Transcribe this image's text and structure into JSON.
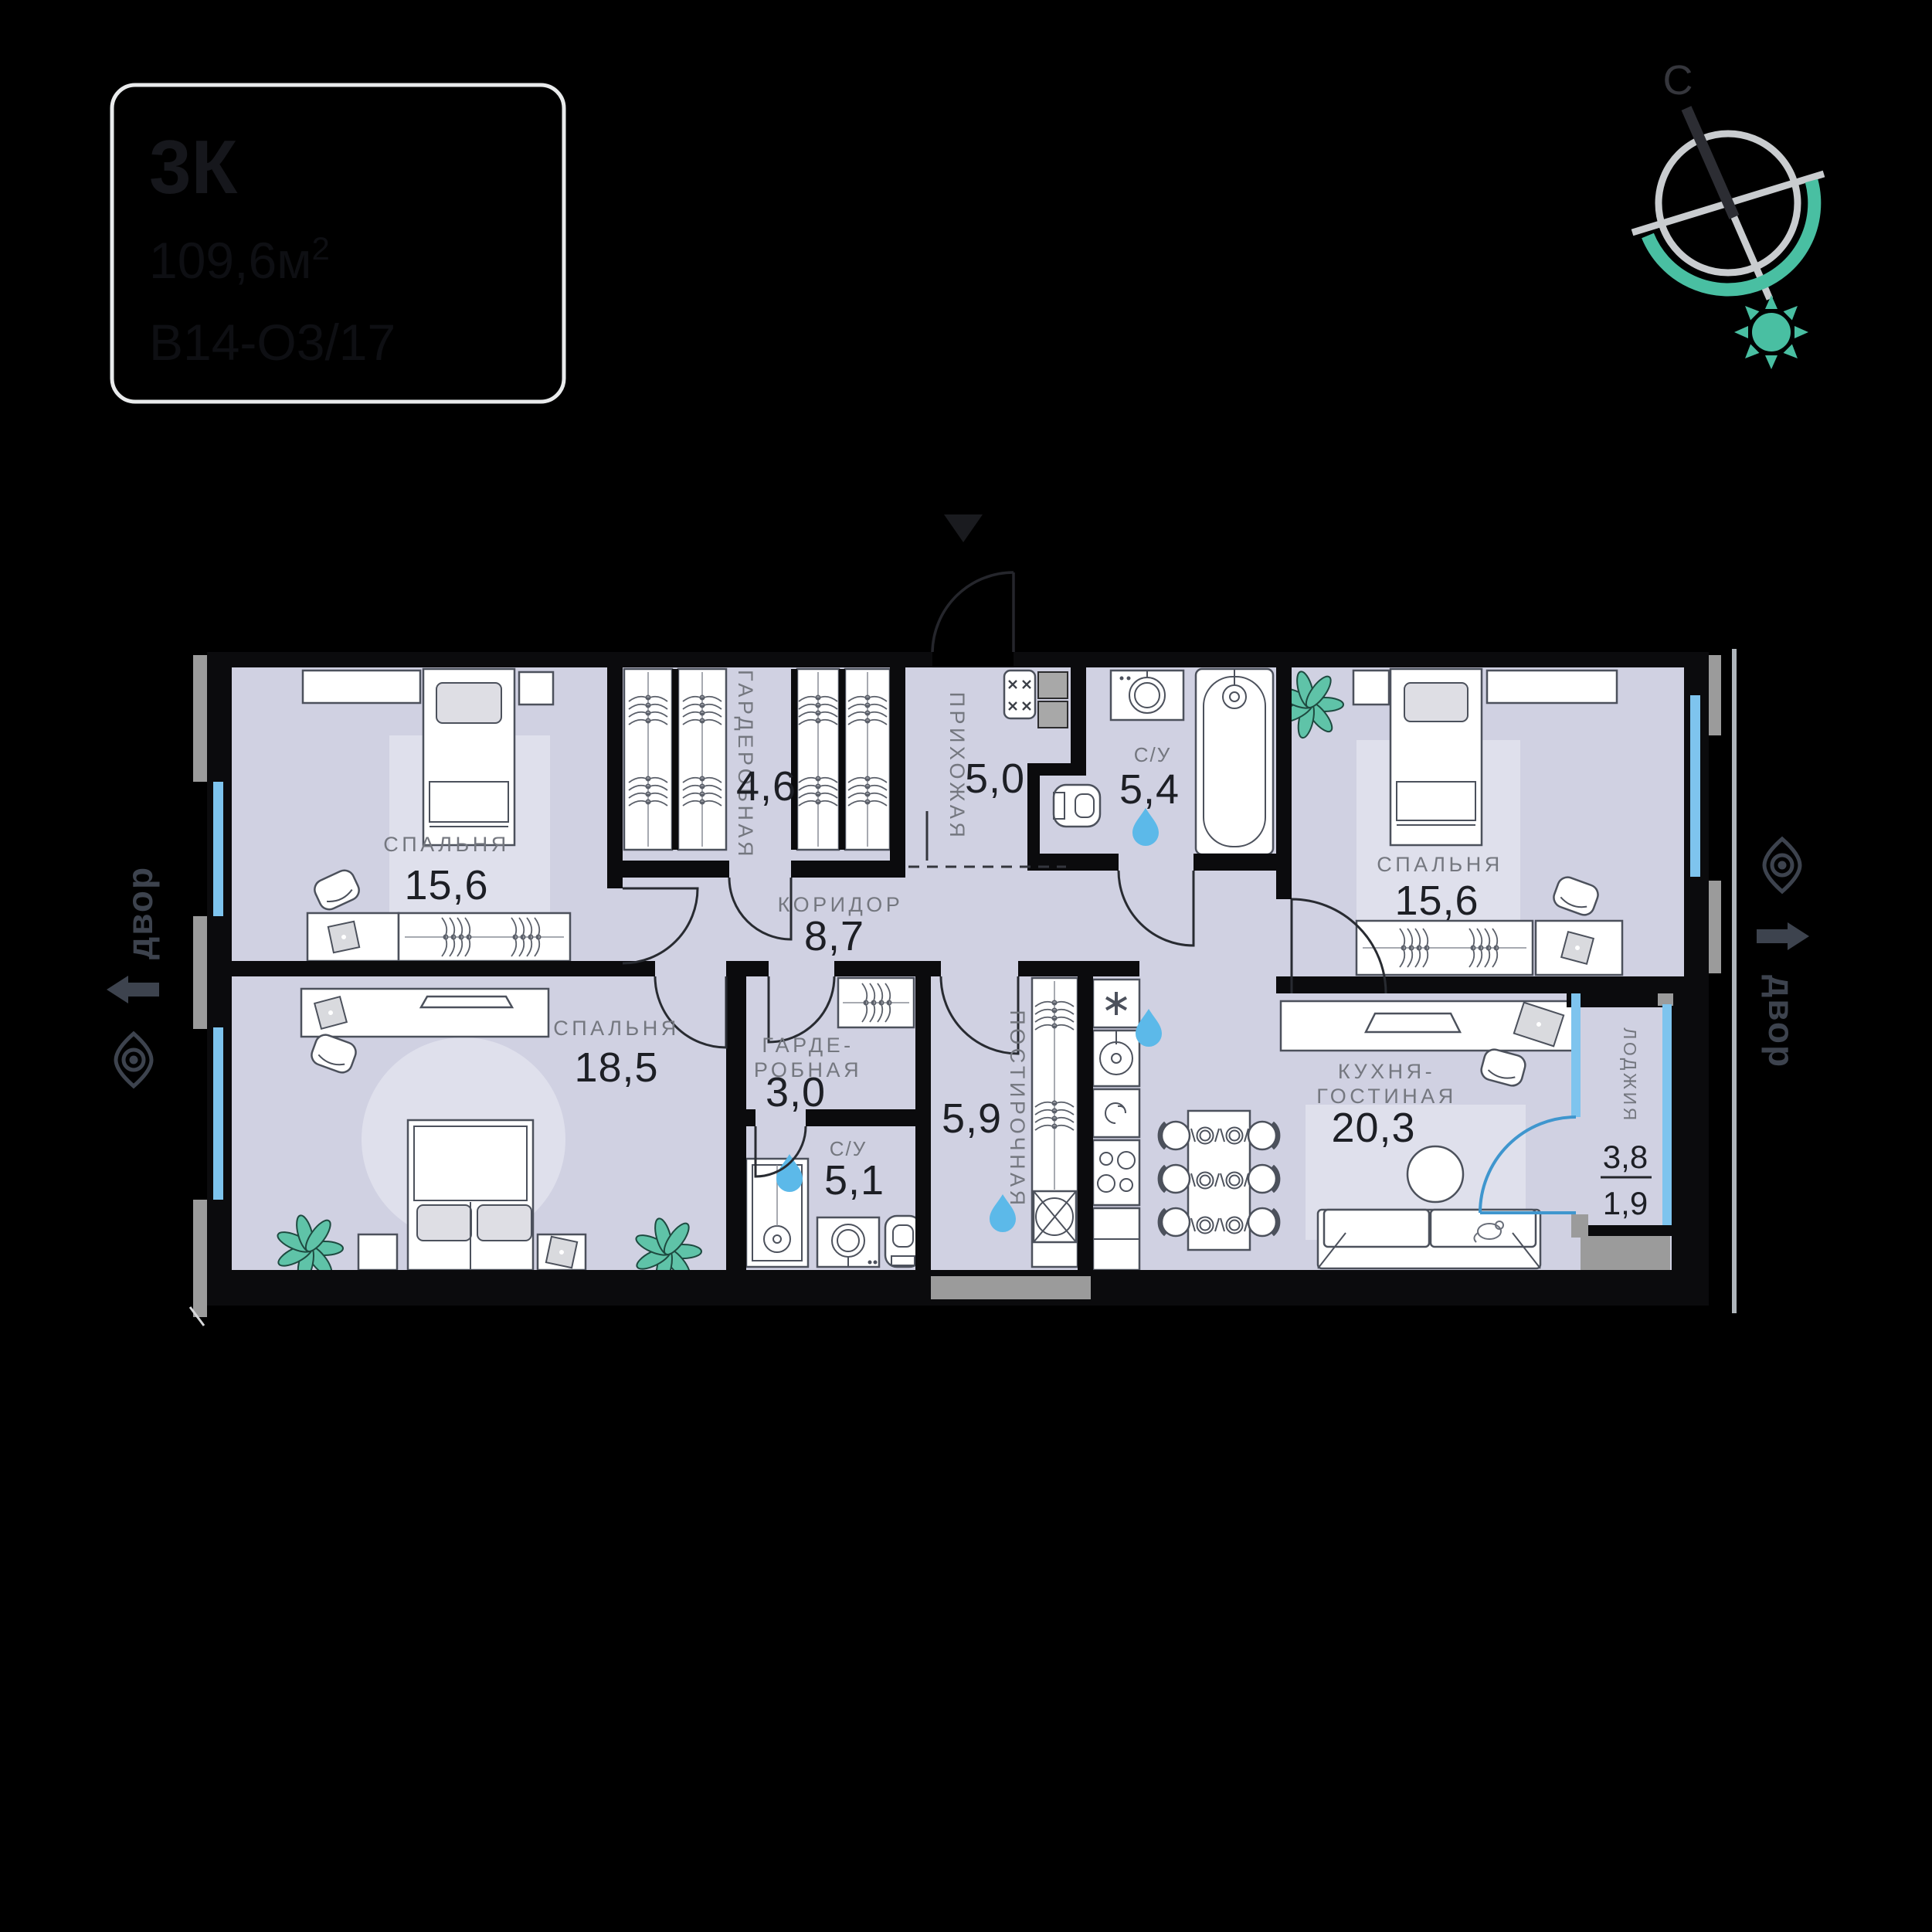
{
  "card": {
    "type": "3К",
    "area_value": "109,6м",
    "area_sup": "2",
    "unit": "В14-О3/17"
  },
  "compass": {
    "north_label": "С"
  },
  "site": {
    "left": {
      "label": "двор"
    },
    "right": {
      "label": "двор"
    }
  },
  "rooms": {
    "bedroom_top_left": {
      "name": "СПАЛЬНЯ",
      "area": "15,6"
    },
    "wardrobe": {
      "name": "ГАРДЕРОБНАЯ",
      "area": "4,6"
    },
    "hallway": {
      "name": "ПРИХОЖАЯ",
      "area": "5,0"
    },
    "bathroom_main": {
      "name": "С/У",
      "area": "5,4"
    },
    "bedroom_top_right": {
      "name": "СПАЛЬНЯ",
      "area": "15,6"
    },
    "corridor": {
      "name": "КОРИДОР",
      "area": "8,7"
    },
    "bedroom_bottom_left": {
      "name": "СПАЛЬНЯ",
      "area": "18,5"
    },
    "wardrobe_small": {
      "name_line1": "ГАРДЕ-",
      "name_line2": "РОБНАЯ",
      "area": "3,0"
    },
    "bathroom_small": {
      "name": "С/У",
      "area": "5,1"
    },
    "laundry": {
      "name": "ПОСТИРОЧНАЯ",
      "area": "5,9"
    },
    "kitchen_living": {
      "name_line1": "КУХНЯ-",
      "name_line2": "ГОСТИНАЯ",
      "area": "20,3"
    },
    "loggia": {
      "name": "ЛОДЖИЯ",
      "area_total": "3,8",
      "area_counted": "1,9"
    }
  },
  "colors": {
    "background": "#000000",
    "room_fill": "#d0d1e2",
    "rug_fill": "#dfe0ec",
    "wall": "#0b0b0d",
    "accent_teal": "#49bfa2",
    "window_blue": "#7ec4ee",
    "water_drop_blue": "#5cb9e9",
    "loggia_door_blue": "#3f96ce",
    "label_gray": "#74777f",
    "number_dark": "#1d1f25",
    "site_label": "#3d434e",
    "card_border": "#e9ebec",
    "facade_gray": "#9b9b9b"
  }
}
